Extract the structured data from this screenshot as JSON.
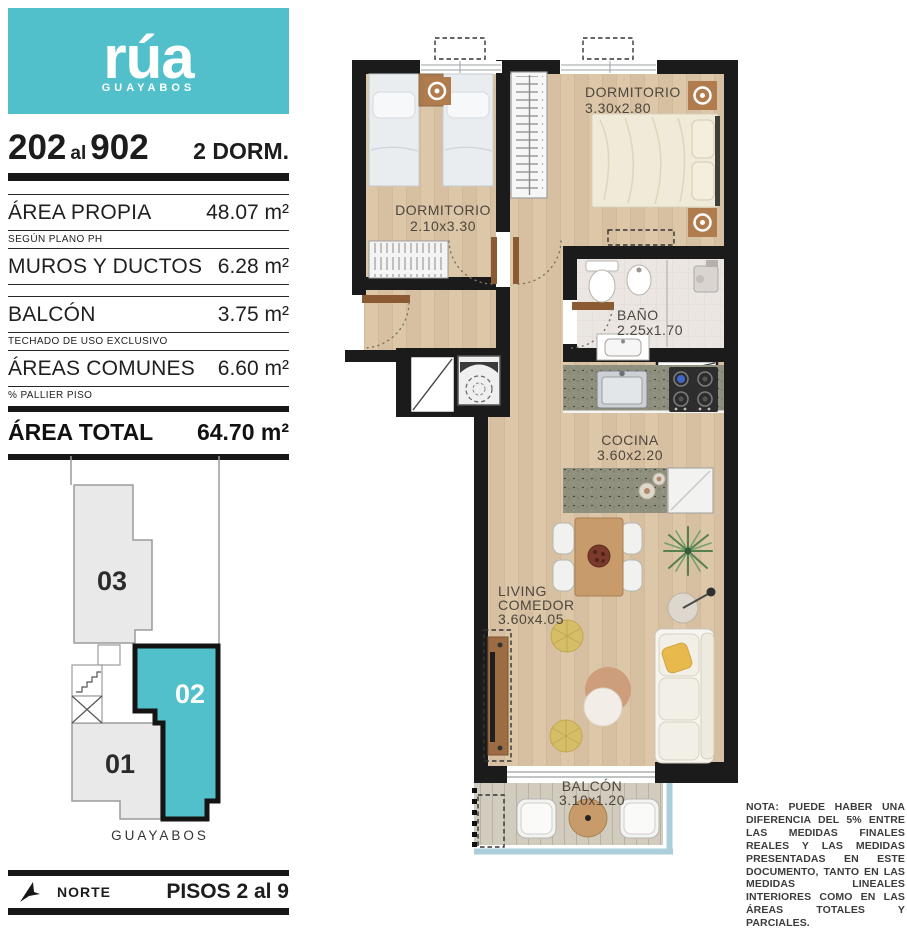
{
  "logo": {
    "brand": "rúa",
    "sub": "GUAYABOS"
  },
  "header": {
    "from": "202",
    "al": "al",
    "to": "902",
    "type": "2 DORM."
  },
  "areas": {
    "rows": [
      {
        "label": "ÁREA PROPIA",
        "sub": "SEGÚN PLANO PH",
        "value": "48.07 m²"
      },
      {
        "label": "MUROS Y DUCTOS",
        "value": "6.28 m²"
      },
      {
        "label": "BALCÓN",
        "sub": "TECHADO DE USO EXCLUSIVO",
        "value": "3.75 m²"
      },
      {
        "label": "ÁREAS COMUNES",
        "sub": "% PALLIER PISO",
        "value": "6.60 m²"
      }
    ],
    "total": {
      "label": "ÁREA TOTAL",
      "value": "64.70 m²"
    }
  },
  "keyplan": {
    "units": [
      {
        "id": "03"
      },
      {
        "id": "02",
        "highlighted": true
      },
      {
        "id": "01"
      }
    ],
    "street": "GUAYABOS"
  },
  "plan": {
    "rooms": {
      "dorm1": {
        "name": "DORMITORIO",
        "dims": "2.10x3.30"
      },
      "dorm2": {
        "name": "DORMITORIO",
        "dims": "3.30x2.80"
      },
      "bath": {
        "name": "BAÑO",
        "dims": "2.25x1.70"
      },
      "kitchen": {
        "name": "COCINA",
        "dims": "3.60x2.20"
      },
      "living": {
        "line1": "LIVING",
        "line2": "COMEDOR",
        "dims": "3.60x4.05"
      },
      "balcony": {
        "name": "BALCÓN",
        "dims": "3.10x1.20"
      }
    }
  },
  "footer": {
    "north": "NORTE",
    "floors": "PISOS 2 al 9"
  },
  "note": "NOTA: PUEDE HABER UNA DIFERENCIA DEL 5% ENTRE LAS MEDIDAS FINALES REALES Y LAS MEDIDAS PRESENTADAS EN ESTE DOCUMENTO, TANTO EN LAS MEDIDAS LINEALES INTERIORES COMO EN LAS ÁREAS TOTALES Y PARCIALES.",
  "colors": {
    "accent": "#52c0cb",
    "wall": "#1b1b1b",
    "wood": "#dcc7a9",
    "balcony_rail": "#aacfdb"
  }
}
